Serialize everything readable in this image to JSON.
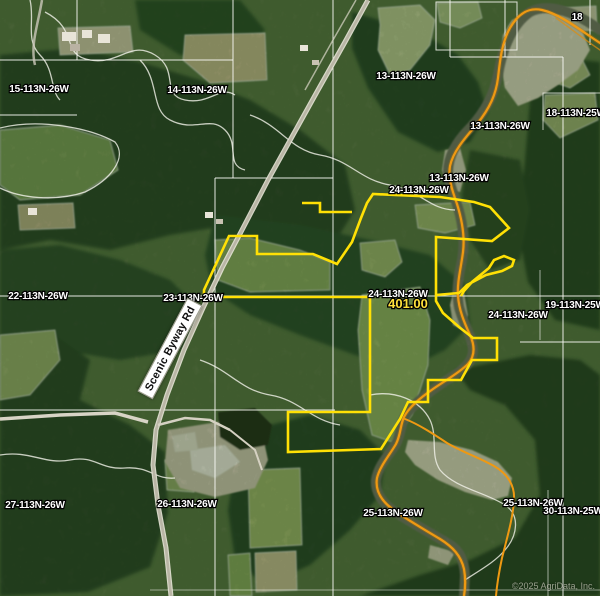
{
  "map": {
    "watermark": "©2025 AgriData, Inc.",
    "road_label": "Scenic Byway Rd",
    "parcel": {
      "acreage": "401.00",
      "boundary_color": "#ffe005",
      "acreage_color": "#ffe13b"
    },
    "trail_color": "#ef9912",
    "section_line_color": "#fafaf5",
    "acreage_label": {
      "text": "401.00",
      "x": 408,
      "y": 308
    },
    "corner_label": {
      "text": "18",
      "x": 577,
      "y": 20
    },
    "section_labels": [
      {
        "text": "15-113N-26W",
        "x": 39,
        "y": 92
      },
      {
        "text": "14-113N-26W",
        "x": 197,
        "y": 93
      },
      {
        "text": "13-113N-26W",
        "x": 406,
        "y": 79
      },
      {
        "text": "13-113N-26W",
        "x": 500,
        "y": 129
      },
      {
        "text": "18-113N-25W",
        "x": 576,
        "y": 116
      },
      {
        "text": "13-113N-26W",
        "x": 459,
        "y": 181
      },
      {
        "text": "24-113N-26W",
        "x": 419,
        "y": 193
      },
      {
        "text": "22-113N-26W",
        "x": 38,
        "y": 299
      },
      {
        "text": "23-113N-26W",
        "x": 193,
        "y": 301
      },
      {
        "text": "24-113N-26W",
        "x": 398,
        "y": 297
      },
      {
        "text": "24-113N-26W",
        "x": 518,
        "y": 318
      },
      {
        "text": "19-113N-25W",
        "x": 575,
        "y": 308
      },
      {
        "text": "25-113N-26W",
        "x": 393,
        "y": 516
      },
      {
        "text": "25-113N-26W",
        "x": 533,
        "y": 506
      },
      {
        "text": "30-113N-25W",
        "x": 573,
        "y": 514
      },
      {
        "text": "27-113N-26W",
        "x": 35,
        "y": 508
      },
      {
        "text": "26-113N-26W",
        "x": 187,
        "y": 507
      }
    ]
  }
}
